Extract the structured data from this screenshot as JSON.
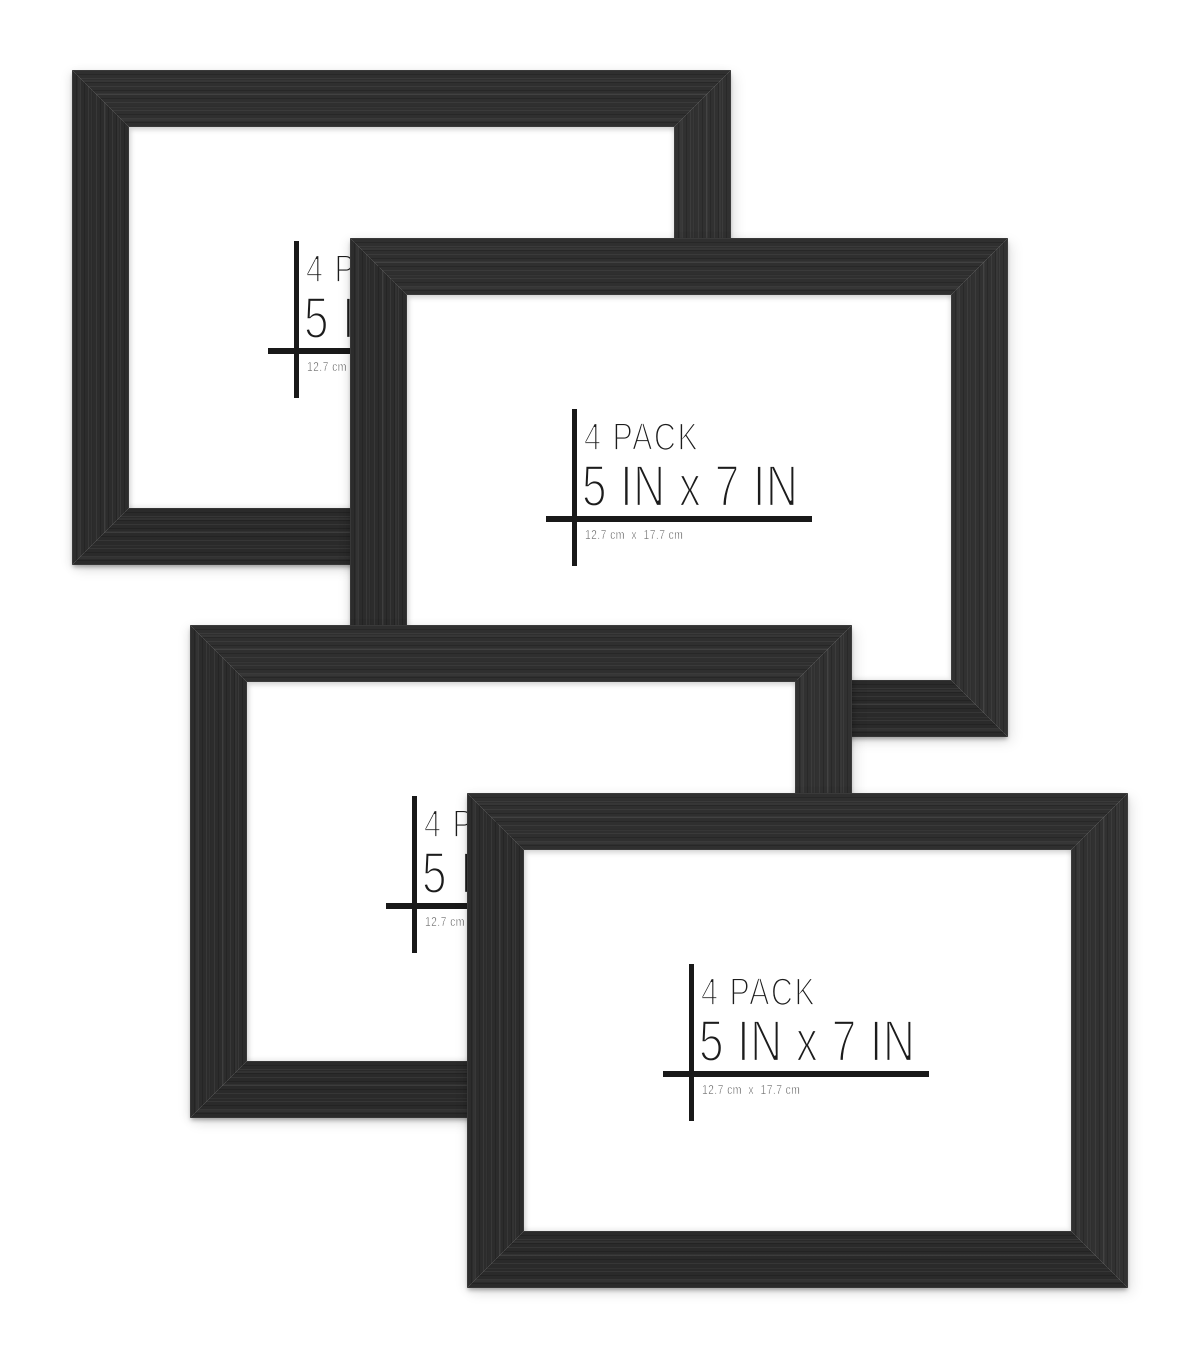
{
  "product": {
    "pack_label": "4 PACK",
    "size_label": "5 IN x 7 IN",
    "metric_label": "12.7 cm  x  17.7 cm"
  },
  "frames": [
    {
      "name": "picture-frame-1"
    },
    {
      "name": "picture-frame-2"
    },
    {
      "name": "picture-frame-3"
    },
    {
      "name": "picture-frame-4"
    }
  ],
  "colors": {
    "frame_wood": "#2e2e2e",
    "mat": "#ffffff",
    "background": "#ffffff",
    "label_text": "#1c1c1c",
    "crosshair": "#191919"
  }
}
